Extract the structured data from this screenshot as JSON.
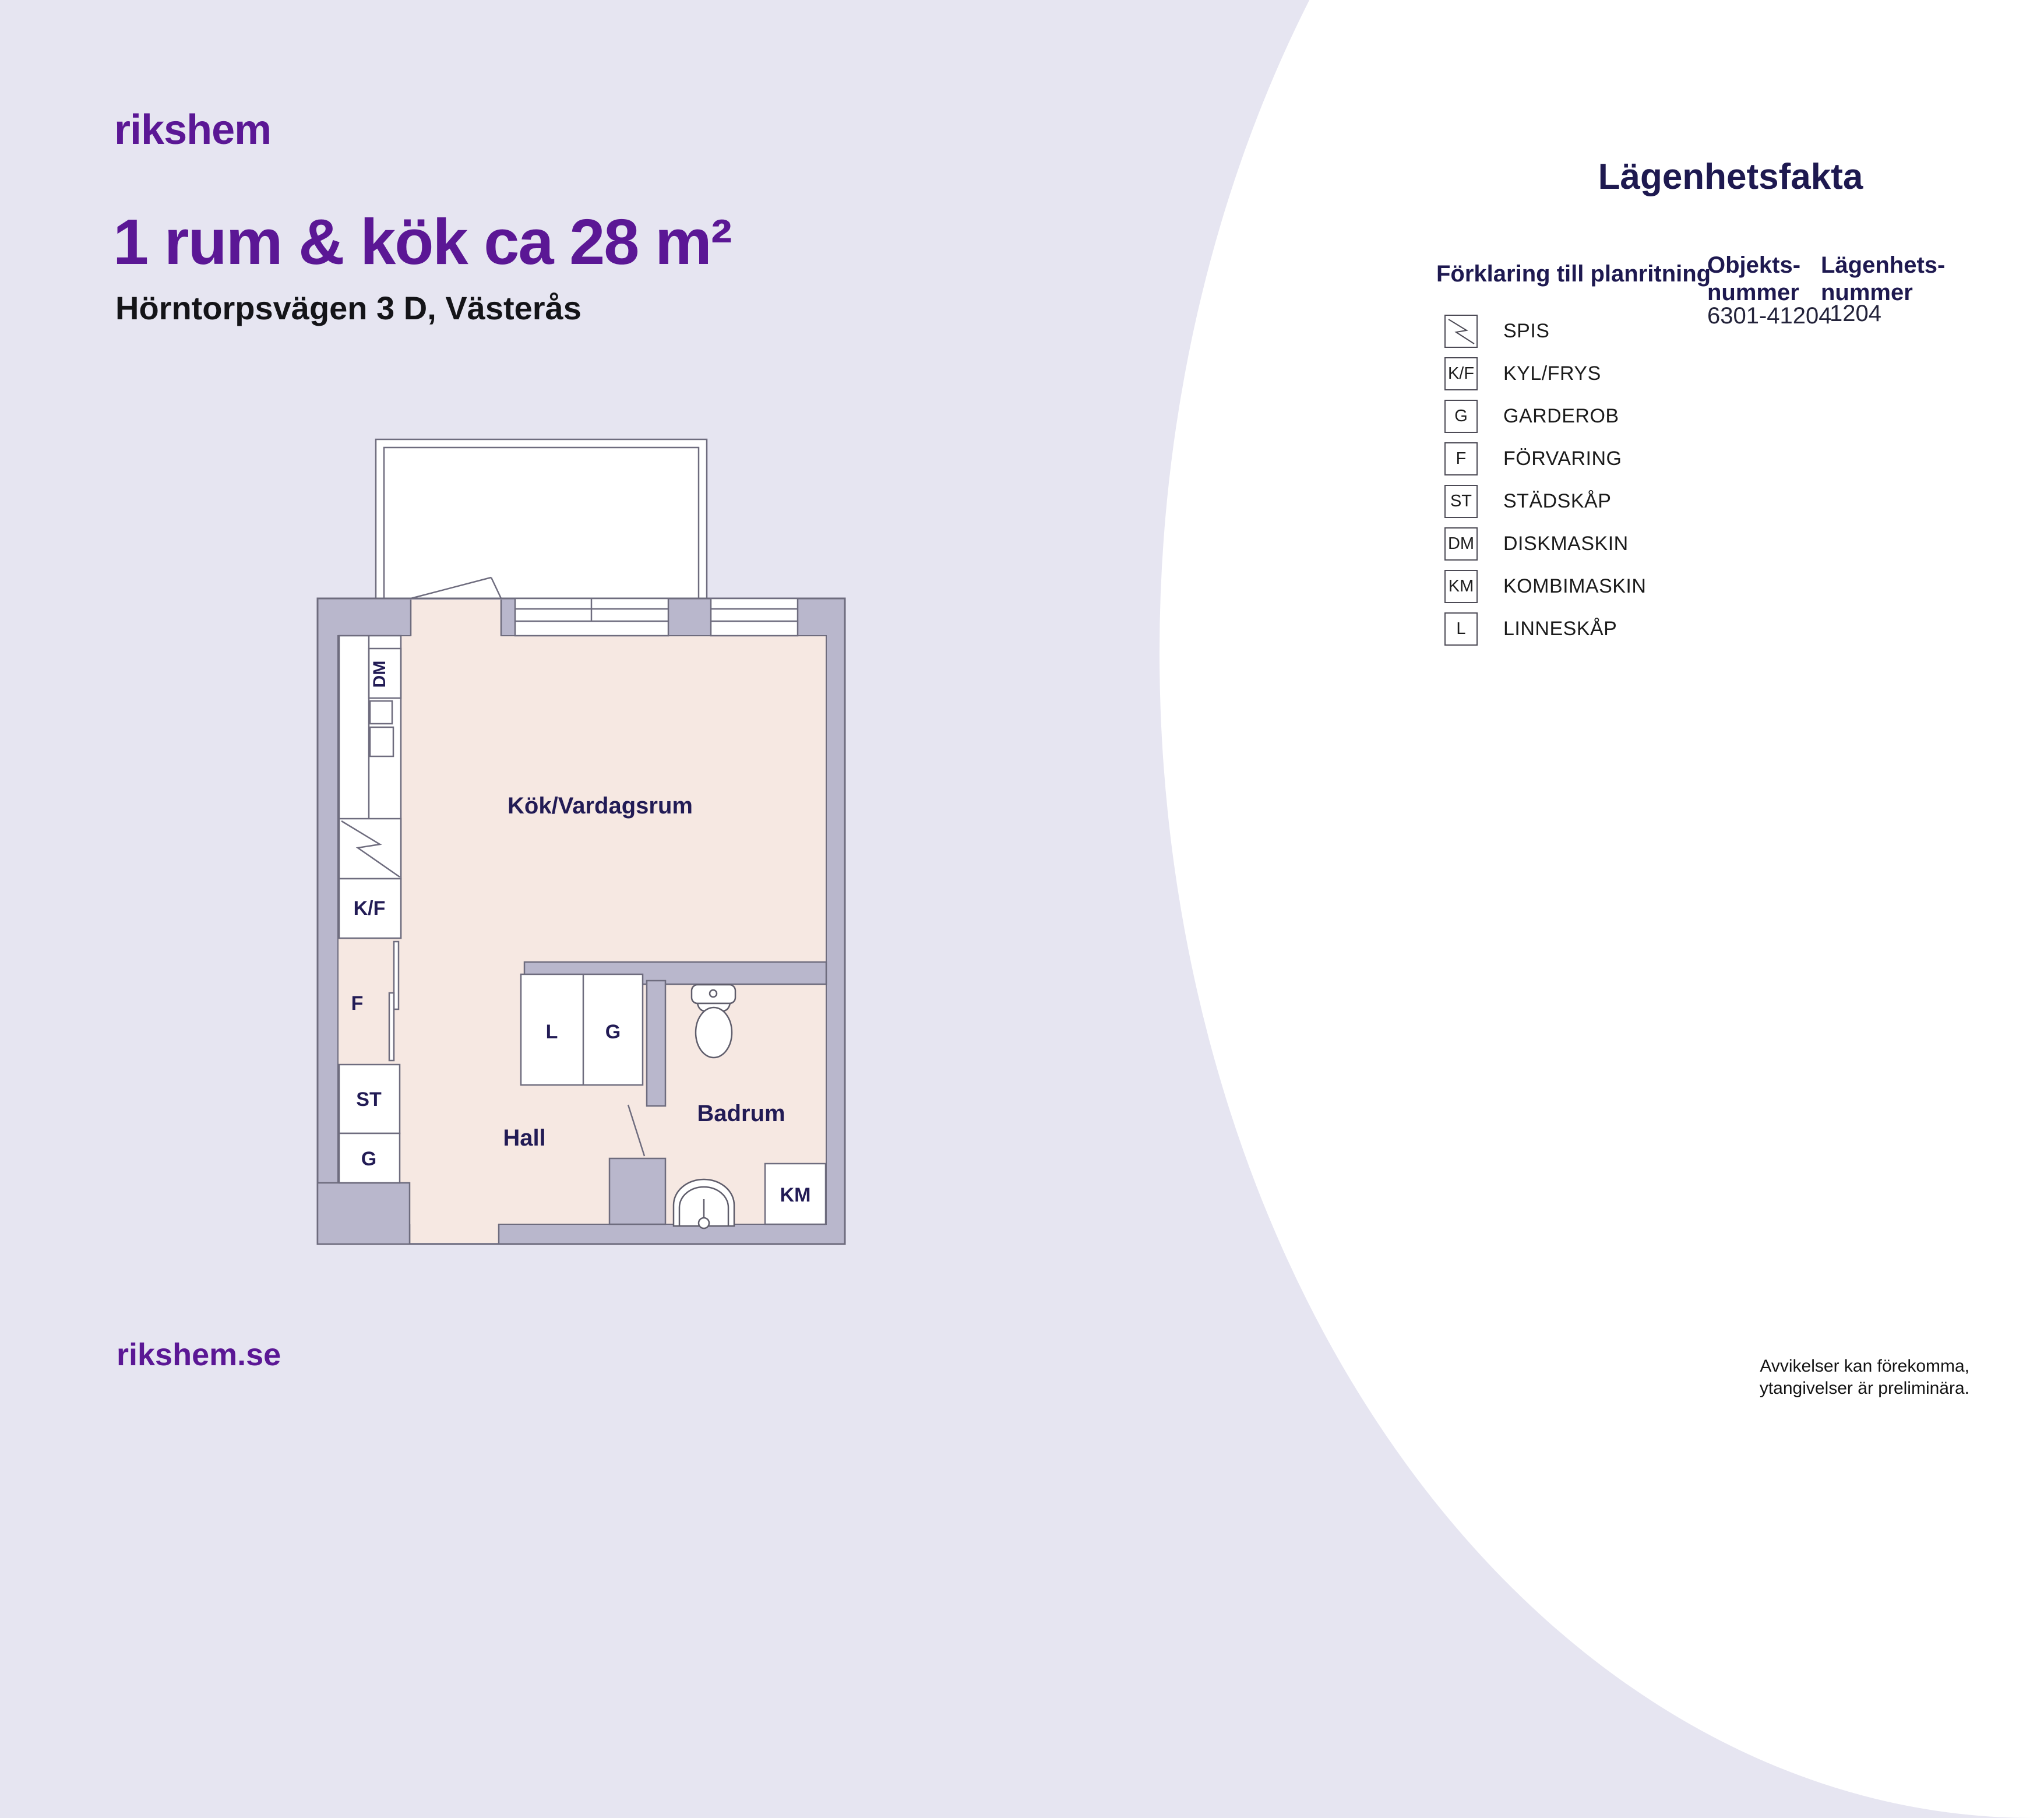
{
  "page": {
    "logo": "rikshem",
    "title": "1 rum & kök ca 28 m²",
    "subtitle": "Hörntorpsvägen 3 D, Västerås",
    "footer_url": "rikshem.se",
    "disclaimer_line1": "Avvikelser kan förekomma,",
    "disclaimer_line2": "ytangivelser är preliminära."
  },
  "facts": {
    "heading": "Lägenhetsfakta",
    "legend_heading": "Förklaring till planritning",
    "object_number_label_line1": "Objekts-",
    "object_number_label_line2": "nummer",
    "object_number_value": "6301-41204",
    "apartment_number_label_line1": "Lägenhets-",
    "apartment_number_label_line2": "nummer",
    "apartment_number_value": "1204",
    "legend": [
      {
        "code": "",
        "label": "SPIS",
        "icon": "spis-zigzag-icon"
      },
      {
        "code": "K/F",
        "label": "KYL/FRYS"
      },
      {
        "code": "G",
        "label": "GARDEROB"
      },
      {
        "code": "F",
        "label": "FÖRVARING"
      },
      {
        "code": "ST",
        "label": "STÄDSKÅP"
      },
      {
        "code": "DM",
        "label": "DISKMASKIN"
      },
      {
        "code": "KM",
        "label": "KOMBIMASKIN"
      },
      {
        "code": "L",
        "label": "LINNESKÅP"
      }
    ]
  },
  "floorplan": {
    "room_main": "Kök/Vardagsrum",
    "room_hall": "Hall",
    "room_bathroom": "Badrum",
    "marker_dm": "DM",
    "marker_kf": "K/F",
    "marker_f": "F",
    "marker_st": "ST",
    "marker_g": "G",
    "marker_l": "L",
    "marker_g2": "G",
    "marker_km": "KM",
    "colors": {
      "wall": "#b9b7cc",
      "floor": "#f6e8e2",
      "outline": "#6e6c7e",
      "label_navy": "#221b55"
    }
  },
  "colors": {
    "background": "#e6e5f1",
    "brand_purple": "#5b1795",
    "heading_navy": "#1e1950"
  }
}
